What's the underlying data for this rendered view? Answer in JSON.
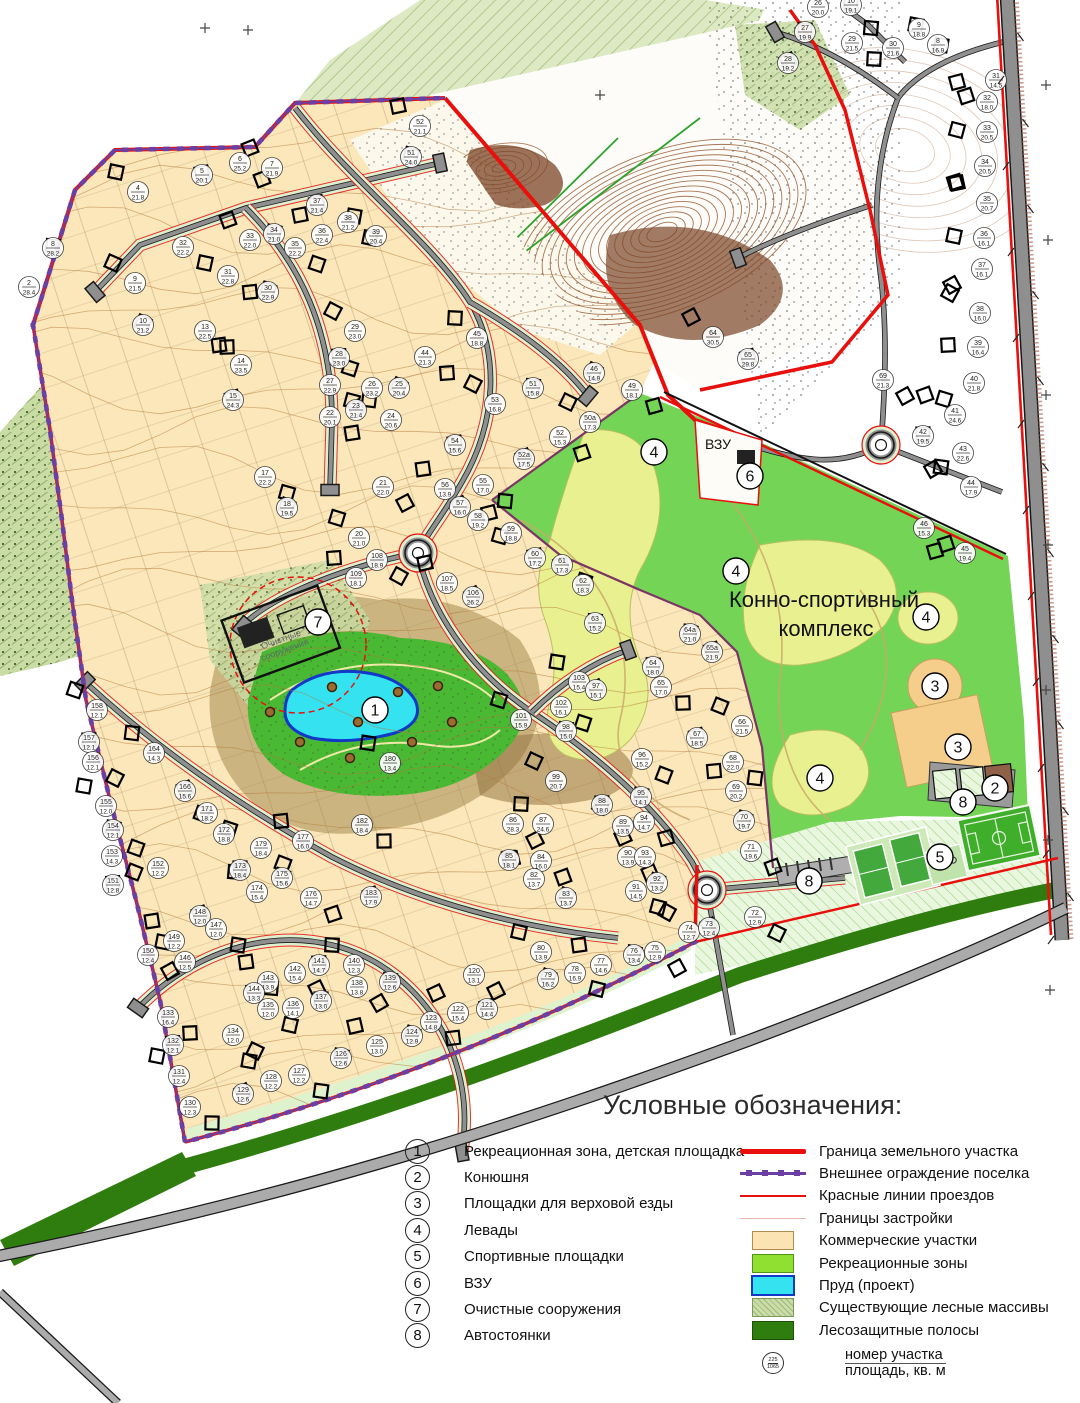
{
  "map": {
    "labels": {
      "complex_line1": "Конно-спортивный",
      "complex_line2": "комплекс",
      "vzu": "ВЗУ",
      "treatment_line1": "Очистные",
      "treatment_line2": "сооружения"
    },
    "markers": [
      {
        "n": "1",
        "x": 375,
        "y": 710
      },
      {
        "n": "2",
        "x": 995,
        "y": 788
      },
      {
        "n": "3",
        "x": 935,
        "y": 686
      },
      {
        "n": "3",
        "x": 958,
        "y": 747
      },
      {
        "n": "4",
        "x": 654,
        "y": 452
      },
      {
        "n": "4",
        "x": 736,
        "y": 571
      },
      {
        "n": "4",
        "x": 926,
        "y": 617
      },
      {
        "n": "4",
        "x": 820,
        "y": 778
      },
      {
        "n": "5",
        "x": 940,
        "y": 857
      },
      {
        "n": "6",
        "x": 750,
        "y": 476
      },
      {
        "n": "7",
        "x": 318,
        "y": 622
      },
      {
        "n": "8",
        "x": 963,
        "y": 802
      },
      {
        "n": "8",
        "x": 809,
        "y": 881
      }
    ],
    "plots": [
      [
        "4",
        "21.8",
        138,
        192
      ],
      [
        "5",
        "20.1",
        202,
        175
      ],
      [
        "6",
        "25.2",
        240,
        163
      ],
      [
        "7",
        "21.9",
        272,
        168
      ],
      [
        "8",
        "28.2",
        53,
        248
      ],
      [
        "2",
        "28.4",
        29,
        287
      ],
      [
        "9",
        "21.5",
        135,
        283
      ],
      [
        "10",
        "21.2",
        143,
        325
      ],
      [
        "13",
        "22.5",
        205,
        331
      ],
      [
        "14",
        "23.5",
        241,
        365
      ],
      [
        "15",
        "24.3",
        233,
        400
      ],
      [
        "32",
        "22.2",
        183,
        247
      ],
      [
        "33",
        "22.0",
        250,
        240
      ],
      [
        "34",
        "21.0",
        274,
        234
      ],
      [
        "35",
        "22.2",
        295,
        248
      ],
      [
        "36",
        "22.4",
        322,
        235
      ],
      [
        "37",
        "21.4",
        317,
        205
      ],
      [
        "38",
        "21.2",
        348,
        222
      ],
      [
        "39",
        "20.4",
        376,
        236
      ],
      [
        "30",
        "22.9",
        268,
        292
      ],
      [
        "31",
        "22.8",
        228,
        276
      ],
      [
        "29",
        "23.0",
        355,
        331
      ],
      [
        "28",
        "23.0",
        339,
        358
      ],
      [
        "27",
        "22.9",
        330,
        385
      ],
      [
        "26",
        "23.2",
        372,
        388
      ],
      [
        "23",
        "21.4",
        356,
        410
      ],
      [
        "22",
        "20.1",
        330,
        417
      ],
      [
        "24",
        "20.6",
        391,
        420
      ],
      [
        "25",
        "20.4",
        399,
        388
      ],
      [
        "44",
        "21.3",
        425,
        357
      ],
      [
        "45",
        "18.8",
        477,
        338
      ],
      [
        "46",
        "14.9",
        594,
        373
      ],
      [
        "49",
        "18.1",
        632,
        390
      ],
      [
        "50а",
        "17.3",
        590,
        422
      ],
      [
        "51",
        "15.8",
        533,
        388
      ],
      [
        "52",
        "15.3",
        560,
        437
      ],
      [
        "53",
        "16.8",
        495,
        404
      ],
      [
        "54",
        "15.6",
        455,
        445
      ],
      [
        "55",
        "17.0",
        483,
        485
      ],
      [
        "56",
        "13.9",
        445,
        489
      ],
      [
        "57",
        "16.0",
        460,
        507
      ],
      [
        "58",
        "19.2",
        478,
        520
      ],
      [
        "59",
        "18.8",
        511,
        533
      ],
      [
        "60",
        "17.2",
        535,
        558
      ],
      [
        "61",
        "17.3",
        562,
        565
      ],
      [
        "62",
        "18.3",
        583,
        585
      ],
      [
        "63",
        "15.2",
        595,
        623
      ],
      [
        "21",
        "22.0",
        383,
        487
      ],
      [
        "20",
        "21.0",
        359,
        538
      ],
      [
        "18",
        "19.5",
        287,
        508
      ],
      [
        "17",
        "22.2",
        265,
        477
      ],
      [
        "107",
        "18.5",
        447,
        583
      ],
      [
        "106",
        "26.2",
        473,
        597
      ],
      [
        "108",
        "18.9",
        377,
        560
      ],
      [
        "109",
        "18.1",
        356,
        578
      ],
      [
        "52а",
        "17.5",
        524,
        459
      ],
      [
        "64а",
        "21.0",
        690,
        634
      ],
      [
        "65а",
        "21.9",
        712,
        652
      ],
      [
        "64",
        "18.0",
        653,
        667
      ],
      [
        "65",
        "17.0",
        661,
        687
      ],
      [
        "66",
        "21.5",
        742,
        726
      ],
      [
        "67",
        "18.5",
        697,
        738
      ],
      [
        "68",
        "22.0",
        733,
        762
      ],
      [
        "69",
        "20.2",
        736,
        791
      ],
      [
        "70",
        "19.7",
        744,
        821
      ],
      [
        "71",
        "19.6",
        751,
        851
      ],
      [
        "103",
        "15.4",
        579,
        682
      ],
      [
        "97",
        "15.1",
        596,
        690
      ],
      [
        "102",
        "16.1",
        561,
        707
      ],
      [
        "101",
        "15.9",
        521,
        720
      ],
      [
        "98",
        "15.0",
        566,
        731
      ],
      [
        "96",
        "15.2",
        642,
        759
      ],
      [
        "99",
        "20.7",
        556,
        781
      ],
      [
        "95",
        "14.1",
        641,
        797
      ],
      [
        "94",
        "14.7",
        644,
        822
      ],
      [
        "89",
        "13.5",
        623,
        826
      ],
      [
        "88",
        "18.0",
        602,
        805
      ],
      [
        "86",
        "28.3",
        513,
        824
      ],
      [
        "87",
        "24.6",
        543,
        824
      ],
      [
        "85",
        "18.1",
        509,
        860
      ],
      [
        "84",
        "16.0",
        541,
        861
      ],
      [
        "82",
        "13.7",
        534,
        879
      ],
      [
        "83",
        "13.7",
        566,
        898
      ],
      [
        "90",
        "13.9",
        628,
        857
      ],
      [
        "93",
        "14.3",
        645,
        857
      ],
      [
        "92",
        "13.2",
        657,
        883
      ],
      [
        "91",
        "14.5",
        636,
        891
      ],
      [
        "158",
        "12.1",
        97,
        710
      ],
      [
        "157",
        "12.1",
        89,
        742
      ],
      [
        "156",
        "12.1",
        93,
        762
      ],
      [
        "155",
        "12.0",
        106,
        806
      ],
      [
        "154",
        "12.1",
        113,
        830
      ],
      [
        "153",
        "14.3",
        112,
        856
      ],
      [
        "152",
        "12.2",
        158,
        868
      ],
      [
        "151",
        "12.8",
        113,
        885
      ],
      [
        "150",
        "12.4",
        148,
        955
      ],
      [
        "164",
        "14.3",
        154,
        753
      ],
      [
        "166",
        "15.6",
        185,
        791
      ],
      [
        "171",
        "18.2",
        207,
        813
      ],
      [
        "172",
        "18.8",
        224,
        834
      ],
      [
        "173",
        "18.4",
        240,
        870
      ],
      [
        "179",
        "18.4",
        261,
        848
      ],
      [
        "174",
        "15.4",
        257,
        892
      ],
      [
        "175",
        "15.6",
        282,
        878
      ],
      [
        "176",
        "14.7",
        311,
        898
      ],
      [
        "177",
        "16.0",
        303,
        841
      ],
      [
        "148",
        "12.0",
        200,
        916
      ],
      [
        "147",
        "12.0",
        216,
        929
      ],
      [
        "149",
        "12.2",
        174,
        941
      ],
      [
        "183",
        "17.9",
        371,
        897
      ],
      [
        "182",
        "18.4",
        362,
        825
      ],
      [
        "180",
        "13.4",
        390,
        763
      ],
      [
        "141",
        "14.7",
        319,
        965
      ],
      [
        "142",
        "15.4",
        295,
        973
      ],
      [
        "143",
        "13.9",
        268,
        982
      ],
      [
        "144",
        "13.3",
        254,
        993
      ],
      [
        "135",
        "12.0",
        268,
        1009
      ],
      [
        "136",
        "14.1",
        293,
        1008
      ],
      [
        "137",
        "13.0",
        321,
        1001
      ],
      [
        "138",
        "13.8",
        357,
        987
      ],
      [
        "140",
        "12.3",
        354,
        965
      ],
      [
        "139",
        "12.6",
        390,
        982
      ],
      [
        "134",
        "12.0",
        233,
        1035
      ],
      [
        "125",
        "13.0",
        377,
        1046
      ],
      [
        "126",
        "12.6",
        341,
        1058
      ],
      [
        "127",
        "12.2",
        299,
        1075
      ],
      [
        "128",
        "12.2",
        271,
        1081
      ],
      [
        "129",
        "12.6",
        243,
        1094
      ],
      [
        "130",
        "12.3",
        190,
        1107
      ],
      [
        "131",
        "12.4",
        179,
        1076
      ],
      [
        "132",
        "12.1",
        173,
        1045
      ],
      [
        "133",
        "16.4",
        168,
        1017
      ],
      [
        "146",
        "12.5",
        185,
        962
      ],
      [
        "124",
        "12.9",
        412,
        1036
      ],
      [
        "123",
        "14.8",
        431,
        1022
      ],
      [
        "122",
        "15.4",
        458,
        1013
      ],
      [
        "121",
        "14.4",
        487,
        1009
      ],
      [
        "120",
        "13.1",
        474,
        975
      ],
      [
        "80",
        "13.9",
        541,
        952
      ],
      [
        "79",
        "16.2",
        548,
        979
      ],
      [
        "78",
        "16.9",
        575,
        973
      ],
      [
        "77",
        "14.6",
        601,
        965
      ],
      [
        "76",
        "13.4",
        634,
        955
      ],
      [
        "75",
        "12.9",
        655,
        952
      ],
      [
        "74",
        "12.7",
        689,
        932
      ],
      [
        "73",
        "12.4",
        709,
        928
      ],
      [
        "72",
        "12.9",
        755,
        917
      ],
      [
        "26",
        "20.0",
        818,
        7
      ],
      [
        "10",
        "19.1",
        851,
        5
      ],
      [
        "9",
        "18.8",
        919,
        29
      ],
      [
        "8",
        "16.9",
        938,
        45
      ],
      [
        "27",
        "19.9",
        805,
        32
      ],
      [
        "29",
        "21.5",
        852,
        43
      ],
      [
        "30",
        "21.6",
        893,
        48
      ],
      [
        "28",
        "19.2",
        788,
        63
      ],
      [
        "31",
        "14.5",
        996,
        80
      ],
      [
        "32",
        "18.0",
        987,
        102
      ],
      [
        "33",
        "20.5",
        987,
        132
      ],
      [
        "34",
        "20.5",
        985,
        166
      ],
      [
        "35",
        "20.7",
        987,
        203
      ],
      [
        "36",
        "16.1",
        984,
        238
      ],
      [
        "37",
        "16.1",
        982,
        269
      ],
      [
        "38",
        "16.0",
        980,
        313
      ],
      [
        "39",
        "16.4",
        978,
        347
      ],
      [
        "40",
        "21.8",
        974,
        383
      ],
      [
        "41",
        "24.6",
        955,
        415
      ],
      [
        "42",
        "19.5",
        923,
        436
      ],
      [
        "43",
        "22.6",
        963,
        453
      ],
      [
        "44",
        "17.9",
        971,
        487
      ],
      [
        "45",
        "19.4",
        965,
        553
      ],
      [
        "46",
        "15.3",
        924,
        528
      ],
      [
        "64",
        "30.5",
        713,
        337
      ],
      [
        "65",
        "29.8",
        748,
        359
      ],
      [
        "69",
        "21.3",
        883,
        380
      ],
      [
        "52",
        "21.1",
        420,
        126
      ],
      [
        "51",
        "24.0",
        411,
        157
      ]
    ],
    "trees": [
      [
        332,
        687
      ],
      [
        398,
        692
      ],
      [
        300,
        742
      ],
      [
        350,
        758
      ],
      [
        412,
        742
      ],
      [
        452,
        722
      ],
      [
        270,
        712
      ],
      [
        438,
        686
      ],
      [
        358,
        722
      ]
    ],
    "plus_marks": [
      [
        205,
        28
      ],
      [
        248,
        30
      ],
      [
        600,
        95
      ],
      [
        1046,
        85
      ],
      [
        1048,
        240
      ],
      [
        1046,
        395
      ],
      [
        1048,
        545
      ],
      [
        1046,
        690
      ],
      [
        1048,
        840
      ],
      [
        1050,
        990
      ]
    ]
  },
  "colors": {
    "red": "#E8100C",
    "purple": "#6B3FA3",
    "boundary": "#7B3566",
    "tan": "#FBE7B9",
    "tanDark": "#F6CE8C",
    "contour": "#B5793B",
    "ravine": "#8B4A1F",
    "roadGray": "#8F8F8F",
    "casing": "#1A1A1A",
    "mint": "#DFF0D0",
    "green": "#74D455",
    "paddock": "#E9F08F",
    "recGreen": "#49B832",
    "pond": "#35E3F0",
    "pondEdge": "#1238C8",
    "beltGreen": "#2E7D0E",
    "sage": "#CBDCA8",
    "field": "#3FAE2A",
    "court": "#44A93C",
    "courtApron": "#CDE9B8",
    "stable": "#8F6148",
    "treeFill": "#9C6B2F",
    "treeEdge": "#3A2408"
  },
  "legend": {
    "title": "Условные обозначения:",
    "numbered": [
      {
        "n": "1",
        "label": "Рекреационная зона, детская площадка"
      },
      {
        "n": "2",
        "label": "Конюшня"
      },
      {
        "n": "3",
        "label": "Площадки для верховой езды"
      },
      {
        "n": "4",
        "label": "Левады"
      },
      {
        "n": "5",
        "label": "Спортивные площадки"
      },
      {
        "n": "6",
        "label": "ВЗУ"
      },
      {
        "n": "7",
        "label": "Очистные сооружения"
      },
      {
        "n": "8",
        "label": "Автостоянки"
      }
    ],
    "lines": [
      {
        "type": "thick-red",
        "label": "Граница земельного участка"
      },
      {
        "type": "purple-fence",
        "label": "Внешнее ограждение поселка"
      },
      {
        "type": "thin-red",
        "label": "Красные линии проездов"
      },
      {
        "type": "thin-pink",
        "label": "Границы застройки"
      }
    ],
    "swatches": [
      {
        "type": "tan",
        "label": "Коммерческие участки"
      },
      {
        "type": "green",
        "label": "Рекреационные зоны"
      },
      {
        "type": "pond",
        "label": "Пруд (проект)"
      },
      {
        "type": "sage",
        "label": "Существующие лесные массивы"
      },
      {
        "type": "belt",
        "label": "Лесозащитные полосы"
      }
    ],
    "parcel_symbol": {
      "top": "225",
      "bottom": "1065",
      "label_line1": "номер участка",
      "label_line2": "площадь, кв. м"
    }
  }
}
